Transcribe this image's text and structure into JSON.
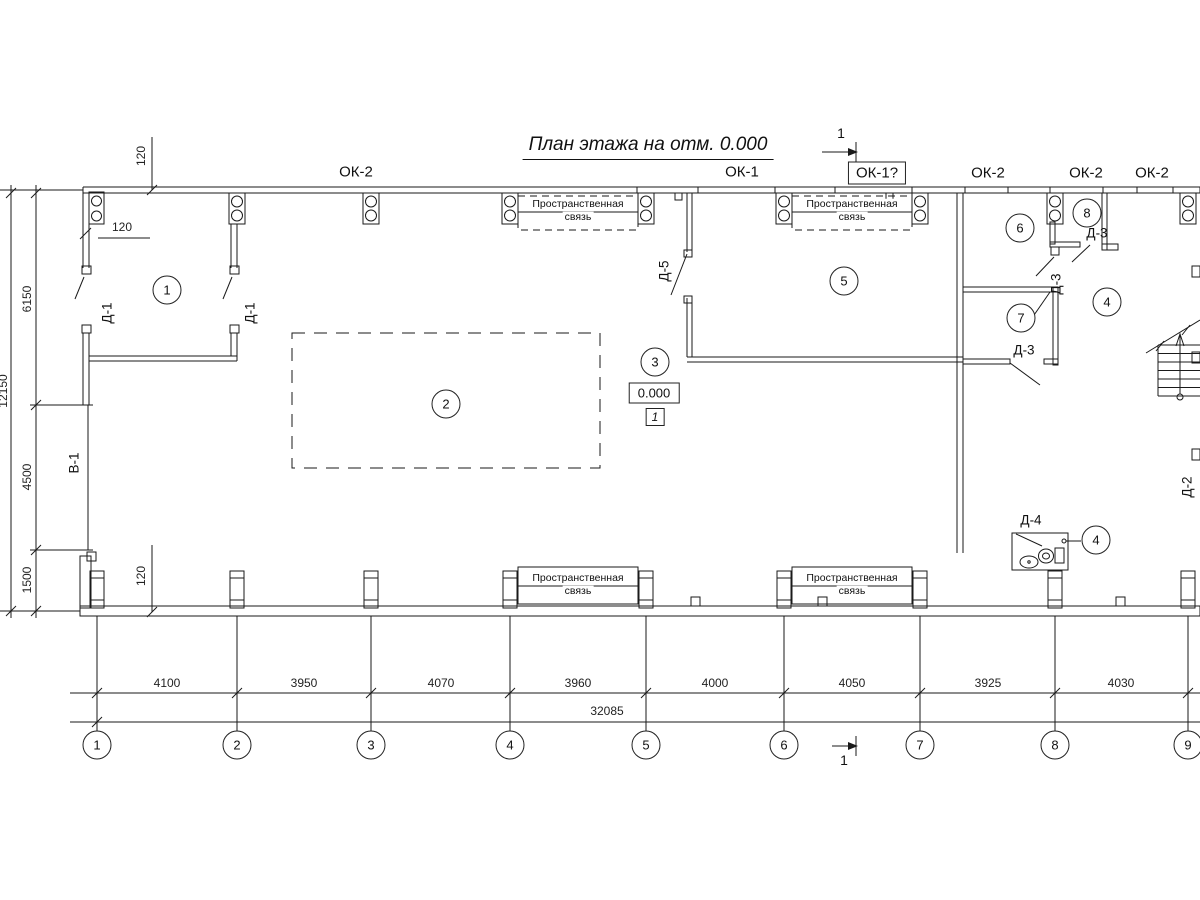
{
  "title": {
    "text": "План этажа на отм. 0.000"
  },
  "boxed_window_label": {
    "text": "ОК-1?"
  },
  "elevation_box": {
    "value": "0.000"
  },
  "node_box": {
    "value": "1"
  },
  "brace_label": {
    "line1": "Пространственная",
    "line2": "связь"
  },
  "window_labels": [
    {
      "text": "ОК-2",
      "x": 356,
      "y": 172
    },
    {
      "text": "ОК-1",
      "x": 742,
      "y": 172
    },
    {
      "text": "ОК-2",
      "x": 988,
      "y": 173
    },
    {
      "text": "ОК-2",
      "x": 1086,
      "y": 173
    },
    {
      "text": "ОК-2",
      "x": 1152,
      "y": 173
    }
  ],
  "door_labels": [
    {
      "text": "Д-1",
      "x": 107,
      "y": 313,
      "rot": true
    },
    {
      "text": "Д-1",
      "x": 250,
      "y": 313,
      "rot": true
    },
    {
      "text": "Д-5",
      "x": 664,
      "y": 271,
      "rot": true
    },
    {
      "text": "Д-3",
      "x": 1056,
      "y": 284,
      "rot": true
    },
    {
      "text": "Д-3",
      "x": 1097,
      "y": 233,
      "rot": false
    },
    {
      "text": "Д-3",
      "x": 1024,
      "y": 350,
      "rot": false
    },
    {
      "text": "Д-4",
      "x": 1031,
      "y": 520,
      "rot": false
    },
    {
      "text": "Д-2",
      "x": 1187,
      "y": 487,
      "rot": true
    },
    {
      "text": "В-1",
      "x": 74,
      "y": 463,
      "rot": true
    }
  ],
  "dimension_labels": [
    {
      "text": "120",
      "x": 141,
      "y": 156,
      "rot": true
    },
    {
      "text": "120",
      "x": 122,
      "y": 227,
      "rot": false
    },
    {
      "text": "120",
      "x": 141,
      "y": 576,
      "rot": true
    },
    {
      "text": "6150",
      "x": 27,
      "y": 299,
      "rot": true
    },
    {
      "text": "4500",
      "x": 27,
      "y": 477,
      "rot": true
    },
    {
      "text": "1500",
      "x": 27,
      "y": 580,
      "rot": true
    },
    {
      "text": "12150",
      "x": 3,
      "y": 391,
      "rot": true
    },
    {
      "text": "4100",
      "x": 167,
      "y": 683
    },
    {
      "text": "3950",
      "x": 304,
      "y": 683
    },
    {
      "text": "4070",
      "x": 441,
      "y": 683
    },
    {
      "text": "3960",
      "x": 578,
      "y": 683
    },
    {
      "text": "4000",
      "x": 715,
      "y": 683
    },
    {
      "text": "4050",
      "x": 852,
      "y": 683
    },
    {
      "text": "3925",
      "x": 988,
      "y": 683
    },
    {
      "text": "4030",
      "x": 1121,
      "y": 683
    },
    {
      "text": "32085",
      "x": 607,
      "y": 711
    }
  ],
  "section_labels": [
    {
      "text": "1",
      "x": 841,
      "y": 133
    },
    {
      "text": "1",
      "x": 844,
      "y": 760
    }
  ],
  "room_tags": [
    {
      "n": "1",
      "x": 167,
      "y": 290
    },
    {
      "n": "2",
      "x": 446,
      "y": 404
    },
    {
      "n": "3",
      "x": 655,
      "y": 362
    },
    {
      "n": "5",
      "x": 844,
      "y": 281
    },
    {
      "n": "6",
      "x": 1020,
      "y": 228
    },
    {
      "n": "8",
      "x": 1087,
      "y": 213
    },
    {
      "n": "7",
      "x": 1021,
      "y": 318
    },
    {
      "n": "4",
      "x": 1107,
      "y": 302
    },
    {
      "n": "4",
      "x": 1096,
      "y": 540
    }
  ],
  "grid_bubbles": [
    {
      "n": "1",
      "x": 97
    },
    {
      "n": "2",
      "x": 237
    },
    {
      "n": "3",
      "x": 371
    },
    {
      "n": "4",
      "x": 510
    },
    {
      "n": "5",
      "x": 646
    },
    {
      "n": "6",
      "x": 784
    },
    {
      "n": "7",
      "x": 920
    },
    {
      "n": "8",
      "x": 1055
    },
    {
      "n": "9",
      "x": 1188
    }
  ],
  "brace_positions": [
    {
      "x": 578,
      "y": 210
    },
    {
      "x": 852,
      "y": 210
    },
    {
      "x": 578,
      "y": 584
    },
    {
      "x": 852,
      "y": 584
    }
  ],
  "colors": {
    "line": "#1a1a1a",
    "gray": "#8a8a8a",
    "wall_fill": "#2b2b2b",
    "background": "#ffffff"
  }
}
